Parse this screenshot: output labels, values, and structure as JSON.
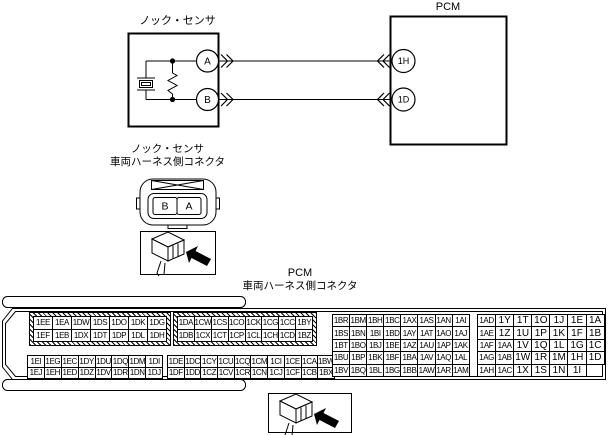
{
  "colors": {
    "line": "#000000",
    "background": "#ffffff"
  },
  "top_diagram": {
    "sensor_label": "ノック・センサ",
    "pcm_label": "PCM",
    "sensor_terminal_a": "A",
    "sensor_terminal_b": "B",
    "pcm_terminal_top": "1H",
    "pcm_terminal_bottom": "1D"
  },
  "sensor_connector": {
    "title_line1": "ノック・センサ",
    "title_line2": "車両ハーネス側コネクタ",
    "pin_left": "B",
    "pin_right": "A"
  },
  "pcm_connector": {
    "title_line1": "PCM",
    "title_line2": "車両ハーネス側コネクタ",
    "blocks": {
      "top_left": {
        "rows": [
          [
            "1EE",
            "1EA",
            "1DW",
            "1DS",
            "1DO",
            "1DK",
            "1DG"
          ],
          [
            "1EF",
            "1EB",
            "1DX",
            "1DT",
            "1DP",
            "1DL",
            "1DH"
          ]
        ]
      },
      "top_mid": {
        "rows": [
          [
            "1DA",
            "1CW",
            "1CS",
            "1CO",
            "1CK",
            "1CG",
            "1CC",
            "1BY"
          ],
          [
            "1DB",
            "1CX",
            "1CT",
            "1CP",
            "1CL",
            "1CH",
            "1CD",
            "1BZ"
          ]
        ]
      },
      "bottom_left": {
        "rows": [
          [
            "1EI",
            "1EG",
            "1EC",
            "1DY",
            "1DU",
            "1DQ",
            "1DM",
            "1DI"
          ],
          [
            "1EJ",
            "1EH",
            "1ED",
            "1DZ",
            "1DV",
            "1DR",
            "1DN",
            "1DJ"
          ]
        ]
      },
      "bottom_mid": {
        "rows": [
          [
            "1DE",
            "1DC",
            "1CY",
            "1CU",
            "1CQ",
            "1CM",
            "1CI",
            "1CE",
            "1CA",
            "1BW"
          ],
          [
            "1DF",
            "1DD",
            "1CZ",
            "1CV",
            "1CR",
            "1CN",
            "1CJ",
            "1CF",
            "1CB",
            "1BX"
          ]
        ]
      },
      "right_mid": {
        "rows": [
          [
            "1BR",
            "1BM",
            "1BH",
            "1BC",
            "1AX",
            "1AS",
            "1AN",
            "1AI"
          ],
          [
            "1BS",
            "1BN",
            "1BI",
            "1BD",
            "1AY",
            "1AT",
            "1AO",
            "1AJ"
          ],
          [
            "1BT",
            "1BO",
            "1BJ",
            "1BE",
            "1AZ",
            "1AU",
            "1AP",
            "1AK"
          ],
          [
            "1BU",
            "1BP",
            "1BK",
            "1BF",
            "1BA",
            "1AV",
            "1AQ",
            "1AL"
          ],
          [
            "1BV",
            "1BQ",
            "1BL",
            "1BG",
            "1BB",
            "1AW",
            "1AR",
            "1AM"
          ]
        ]
      },
      "right": {
        "rows": [
          [
            "1AD",
            "1Y",
            "1T",
            "1O",
            "1J",
            "1E",
            "1A"
          ],
          [
            "1AE",
            "1Z",
            "1U",
            "1P",
            "1K",
            "1F",
            "1B"
          ],
          [
            "1AF",
            "1AA",
            "1V",
            "1Q",
            "1L",
            "1G",
            "1C"
          ],
          [
            "1AG",
            "1AB",
            "1W",
            "1R",
            "1M",
            "1H",
            "1D"
          ],
          [
            "1AH",
            "1AC",
            "1X",
            "1S",
            "1N",
            "1I"
          ]
        ]
      }
    }
  }
}
